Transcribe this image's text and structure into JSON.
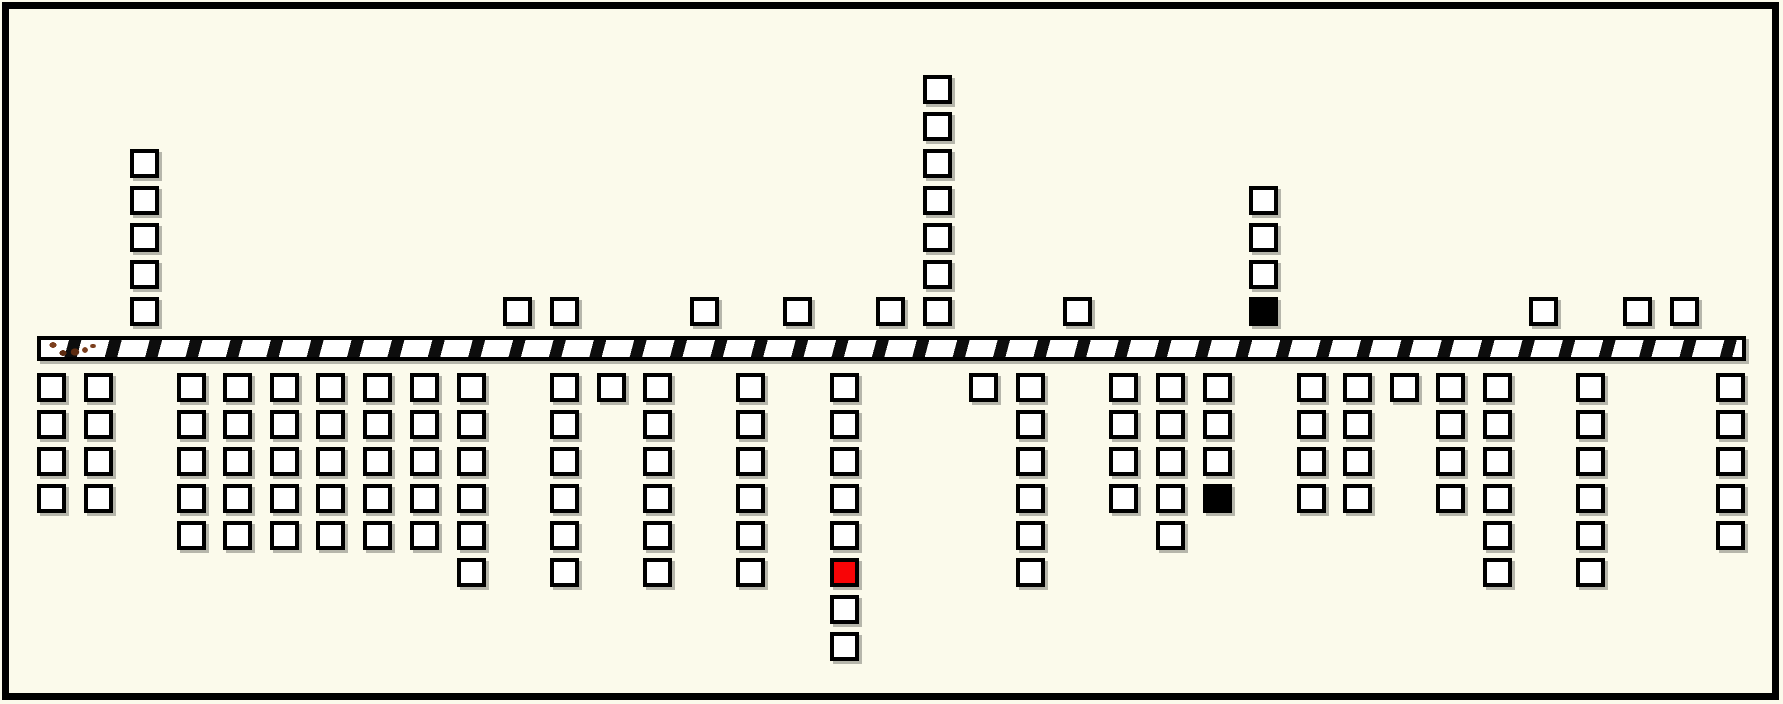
{
  "canvas": {
    "width": 1783,
    "height": 704,
    "background_color": "#FBFAEB",
    "frame_border_color": "#000000"
  },
  "road": {
    "x": 37,
    "y": 336,
    "width": 1709,
    "height": 25,
    "border_color": "#000000",
    "surface_color": "#FFFFFF",
    "spot_color": "#7B3E1D",
    "spot_color_dark": "#5D2B10",
    "stripe_color": "#0D0D0D"
  },
  "squares": {
    "size": 29,
    "row_step": 37,
    "above_base_y": 297,
    "below_base_y": 373,
    "border_color": "#000000",
    "fill_white": "#FFFFFF",
    "fill_black": "#000000",
    "fill_red": "#F80406",
    "above_columns": [
      {
        "x": 130,
        "cells": [
          "W",
          "W",
          "W",
          "W",
          "W"
        ]
      },
      {
        "x": 503,
        "cells": [
          "W"
        ]
      },
      {
        "x": 550,
        "cells": [
          "W"
        ]
      },
      {
        "x": 690,
        "cells": [
          "W"
        ]
      },
      {
        "x": 783,
        "cells": [
          "W"
        ]
      },
      {
        "x": 876,
        "cells": [
          "W"
        ]
      },
      {
        "x": 923,
        "cells": [
          "W",
          "W",
          "W",
          "W",
          "W",
          "W",
          "W"
        ]
      },
      {
        "x": 1063,
        "cells": [
          "W"
        ]
      },
      {
        "x": 1249,
        "cells": [
          "K",
          "W",
          "W",
          "W"
        ]
      },
      {
        "x": 1529,
        "cells": [
          "W"
        ]
      },
      {
        "x": 1623,
        "cells": [
          "W"
        ]
      },
      {
        "x": 1670,
        "cells": [
          "W"
        ]
      }
    ],
    "below_columns": [
      {
        "x": 37,
        "cells": [
          "W",
          "W",
          "W",
          "W"
        ]
      },
      {
        "x": 84,
        "cells": [
          "W",
          "W",
          "W",
          "W"
        ]
      },
      {
        "x": 177,
        "cells": [
          "W",
          "W",
          "W",
          "W",
          "W"
        ]
      },
      {
        "x": 223,
        "cells": [
          "W",
          "W",
          "W",
          "W",
          "W"
        ]
      },
      {
        "x": 270,
        "cells": [
          "W",
          "W",
          "W",
          "W",
          "W"
        ]
      },
      {
        "x": 316,
        "cells": [
          "W",
          "W",
          "W",
          "W",
          "W"
        ]
      },
      {
        "x": 363,
        "cells": [
          "W",
          "W",
          "W",
          "W",
          "W"
        ]
      },
      {
        "x": 410,
        "cells": [
          "W",
          "W",
          "W",
          "W",
          "W"
        ]
      },
      {
        "x": 457,
        "cells": [
          "W",
          "W",
          "W",
          "W",
          "W",
          "W"
        ]
      },
      {
        "x": 550,
        "cells": [
          "W",
          "W",
          "W",
          "W",
          "W",
          "W"
        ]
      },
      {
        "x": 597,
        "cells": [
          "W"
        ]
      },
      {
        "x": 643,
        "cells": [
          "W",
          "W",
          "W",
          "W",
          "W",
          "W"
        ]
      },
      {
        "x": 736,
        "cells": [
          "W",
          "W",
          "W",
          "W",
          "W",
          "W"
        ]
      },
      {
        "x": 830,
        "cells": [
          "W",
          "W",
          "W",
          "W",
          "W",
          "R",
          "W",
          "W"
        ]
      },
      {
        "x": 969,
        "cells": [
          "W"
        ]
      },
      {
        "x": 1016,
        "cells": [
          "W",
          "W",
          "W",
          "W",
          "W",
          "W"
        ]
      },
      {
        "x": 1109,
        "cells": [
          "W",
          "W",
          "W",
          "W"
        ]
      },
      {
        "x": 1156,
        "cells": [
          "W",
          "W",
          "W",
          "W",
          "W"
        ]
      },
      {
        "x": 1203,
        "cells": [
          "W",
          "W",
          "W",
          "K"
        ]
      },
      {
        "x": 1297,
        "cells": [
          "W",
          "W",
          "W",
          "W"
        ]
      },
      {
        "x": 1343,
        "cells": [
          "W",
          "W",
          "W",
          "W"
        ]
      },
      {
        "x": 1390,
        "cells": [
          "W"
        ]
      },
      {
        "x": 1436,
        "cells": [
          "W",
          "W",
          "W",
          "W"
        ]
      },
      {
        "x": 1483,
        "cells": [
          "W",
          "W",
          "W",
          "W",
          "W",
          "W"
        ]
      },
      {
        "x": 1576,
        "cells": [
          "W",
          "W",
          "W",
          "W",
          "W",
          "W"
        ]
      },
      {
        "x": 1716,
        "cells": [
          "W",
          "W",
          "W",
          "W",
          "W"
        ]
      }
    ]
  }
}
